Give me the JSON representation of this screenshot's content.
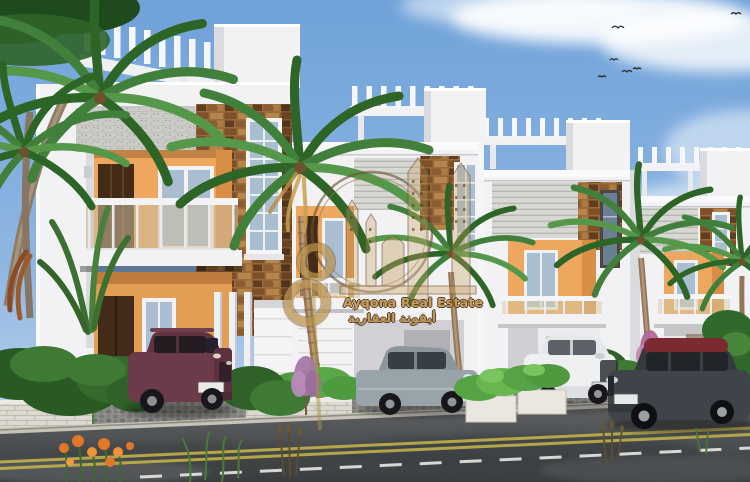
{
  "page": {
    "width": 750,
    "height": 482,
    "kind": "architectural-rendering-photo"
  },
  "watermark": {
    "brand_en": "Ayqona Real Estate",
    "brand_ar": "أيقونة العقارية",
    "logo": "gold-ring-city-skyline-with-figure-8"
  },
  "scene": {
    "sky": "blue sky with soft white clouds and small flying birds",
    "buildings": "row of four two-storey white townhouse villas with roof pergolas, grey textured bands, brown stone cladding, orange balcony recesses and glass railings",
    "vegetation": "palm trees between units, green shrubs, purple bushes, bright hedges, orange flowers in foreground",
    "street": "grey asphalt road with double yellow centre line and white dashed lane marking",
    "vehicles": [
      "maroon SUV",
      "grey sedan",
      "white compact car",
      "dark grey sedan with dark red roof"
    ]
  },
  "colors": {
    "sky_top": "#6fa2d9",
    "sky_horizon": "#c9dcf0",
    "wall_white": "#f2f2f4",
    "wall_shade": "#d9dbdf",
    "texture_grey": "#cbcbc7",
    "stone_brown": "#9a6a3a",
    "balcony_orange": "#eda75f",
    "balcony_orange_shade": "#d88f45",
    "door_brown": "#432b18",
    "glass_blue": "#a9bed1",
    "railing_glass_tan": "#cdbfa0",
    "foliage_green": "#3f7a33",
    "lawn_green": "#4e8040",
    "hedge_green": "#56a245",
    "purple_bush": "#a678a8",
    "road_grey": "#515456",
    "curb_grey": "#c6c3b8",
    "marking_yellow": "#c9b849",
    "marking_white": "#e8e8e6",
    "cobble_grey": "#8f8f8b",
    "suv_maroon": "#6d3a4a",
    "sedan_grey": "#99a3aa",
    "car_white": "#eef0f2",
    "sedan_dark": "#3e4449",
    "sedan_roof_red": "#7c2a32",
    "watermark_gold": "#c79b52",
    "watermark_outline": "#4a3418"
  }
}
